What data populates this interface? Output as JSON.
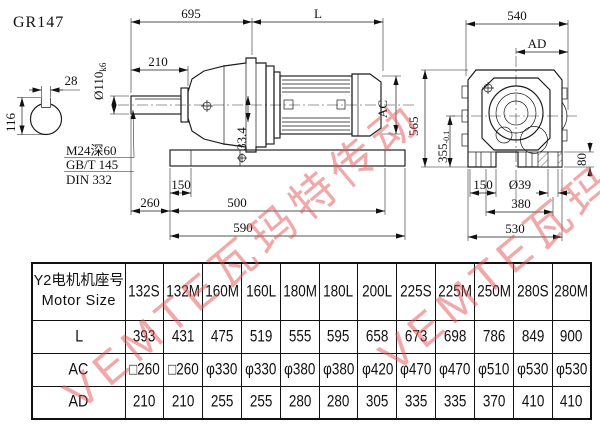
{
  "page": {
    "title": "GR147",
    "watermark": "VEMTE瓦玛特传动"
  },
  "drawing": {
    "front": {
      "dim_695": "695",
      "dim_L": "L",
      "dim_210": "210",
      "shaft_dia": "Ø110",
      "shaft_tol": "k6",
      "dim_28": "28",
      "dim_116": "116",
      "thread_note": "M24深60",
      "standard_1": "GB/T 145",
      "standard_2": "DIN 332",
      "dim_33_4": "33.4",
      "dim_AC": "AC",
      "dim_150": "150",
      "dim_260": "260",
      "dim_500": "500",
      "dim_590": "590"
    },
    "side": {
      "dim_540": "540",
      "dim_AD": "AD",
      "dim_565": "565",
      "dim_355": "355",
      "dim_355_tol": "-0.1",
      "dim_80": "80",
      "dim_150": "150",
      "dim_39": "Ø39",
      "dim_380": "380",
      "dim_530": "530"
    }
  },
  "table": {
    "header_cn": "Y2电机机座号",
    "header_en": "Motor Size",
    "columns": [
      "132S",
      "132M",
      "160M",
      "160L",
      "180M",
      "180L",
      "200L",
      "225S",
      "225M",
      "250M",
      "280S",
      "280M"
    ],
    "rows": [
      {
        "label": "L",
        "values": [
          "393",
          "431",
          "475",
          "519",
          "555",
          "595",
          "658",
          "673",
          "698",
          "786",
          "849",
          "900"
        ]
      },
      {
        "label": "AC",
        "values": [
          "□260",
          "□260",
          "φ330",
          "φ330",
          "φ380",
          "φ380",
          "φ420",
          "φ470",
          "φ470",
          "φ510",
          "φ530",
          "φ530"
        ]
      },
      {
        "label": "AD",
        "values": [
          "210",
          "210",
          "255",
          "255",
          "280",
          "280",
          "305",
          "335",
          "335",
          "370",
          "410",
          "410"
        ]
      }
    ]
  }
}
